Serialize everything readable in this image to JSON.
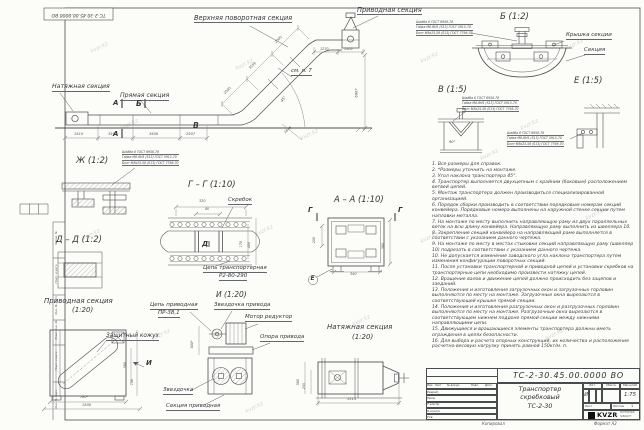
{
  "sheet": {
    "stamp": "ТС-2-30.45.00.0000 ВО",
    "watermark": "kvzr.kz",
    "copy_label": "Копировал",
    "format_label": "Формат А2",
    "frame_labels": [
      "Справ. №",
      "Подп. и дата",
      "Инв. № дубл.",
      "Взам. инв. №",
      "Подп. и дата",
      "Инв. № подл."
    ]
  },
  "main_view": {
    "labels": {
      "tension_section": "Натяжная секция",
      "straight_section": "Прямая секция",
      "upper_turn_section": "Верхняя поворотная секция",
      "drive_section": "Приводная секция",
      "see_note": "см. п. 7"
    },
    "markers": {
      "a": "А",
      "b": "Б",
      "v": "В"
    },
    "dims": {
      "d1": "1515",
      "d2": "3500",
      "d3": "3500",
      "d4": "2507",
      "d5": "1845",
      "d6": "2000",
      "d7": "3559",
      "d8": "2000",
      "d9": "1270",
      "d10": "1505",
      "height": "6907",
      "angle": "45°"
    }
  },
  "fastener_note": {
    "l1": "Шайба 8 ГОСТ 6958-78",
    "l2": "Гайка М8-6Н5 (S13) ГОСТ 5915-70",
    "l3": "Болт М8х25.58 (S13) ГОСТ 7798-70"
  },
  "details": {
    "zh": {
      "title": "Ж (1:2)"
    },
    "gg": {
      "title": "Г – Г (1:10)",
      "scraper": "Скребок",
      "chain1": "Цепь транспортерная",
      "chain2": "Р2-80-290",
      "marker_d": "Д",
      "dims": {
        "w": "320",
        "w2": "80",
        "h1": "170",
        "h2": "400"
      }
    },
    "aa": {
      "title": "А – А (1:10)",
      "marker_g": "Г",
      "marker_e": "Е",
      "dims": {
        "left": "200",
        "right": "380",
        "bottom": "340"
      }
    },
    "b": {
      "title": "Б (1:2)",
      "cover": "Крышка секции",
      "section": "Секция"
    },
    "v": {
      "title": "В (1:5)",
      "angle": "90°"
    },
    "e": {
      "title": "Е (1:5)"
    },
    "dd": {
      "title": "Д – Д (1:2)"
    },
    "drive": {
      "title": "Приводная секция",
      "scale": "(1:20)",
      "cover": "Защитный кожух",
      "marker_i": "И",
      "dims": {
        "d1": "780*",
        "d2": "1500",
        "d3": "560",
        "d4": "700"
      }
    },
    "i": {
      "title": "И (1:20)",
      "chain1": "Цепь приводная",
      "chain2": "ПР-38,1",
      "sprocket_drive": "Звездочка привода",
      "motor": "Мотор редуктор",
      "support": "Опора привода",
      "sprocket": "Звездочка",
      "section": "Секция приводная",
      "dim": "800*"
    },
    "tension": {
      "title": "Натяжная секция",
      "scale": "(1:20)",
      "dims": {
        "l": "1515",
        "h1": "560",
        "h2": "255"
      }
    }
  },
  "notes": [
    "1. Все размеры для справок.",
    "2. *Размеры уточнить на монтаже.",
    "3. Угол наклона транспортера 45°.",
    "4. Транспортер выполняется двухцепным с крайним (боковым) расположением ветвей цепей.",
    "5. Монтаж транспортера должен производиться специализированной организацией.",
    "6. Порядок сборки производить в соответствии порядковым номерам секций конвейера. Порядковые номера выполнены на наружной стенке секции путем наплавки металла.",
    "7. На монтаже по месту выполнить направляющую раму из двух параллельных веток на всю длину конвейера. Направляющую раму выполнить из швеллера 10.",
    "8. Закрепление секций конвейера на направляющей раме выполняется в соответствии с указанием данного чертежа.",
    "9. На монтаже по месту в местах стыковки секций направляющую раму (швеллер 10) подрезать в соответствии с указанием данного чертежа.",
    "10. Не допускается изменение заводского угла наклона транспортера путем изменения конфигурации поворотных секций.",
    "11. После установки транспортерной и приводной цепей и установки скребков на транспортерные цепи необходимо произвести натяжку цепей.",
    "12. Вращение валов и движение цепей должно происходить без зацепов и заеданий.",
    "13. Положения и изготовления загрузочных окон и загрузочных горловин выполняются по месту на монтаже. Загрузочные окна вырезаются в соответствующей крышке прямой секции.",
    "14. Положения и изготовления разгрузочных окон и разгрузочных горловин выполняются по месту на монтаже. Разгрузочные окна вырезаются в соответствующем нижнем поддоне прямой секции между нижними направляющими цепи.",
    "15. Движущиеся и вращающиеся элементы транспортера должны иметь ограждения в целях безопасности.",
    "16. Для выбора и расчета опорных конструкций, их количества и расположения расчетно-весовую нагрузку принять равной 150кг/м. п."
  ],
  "title_block": {
    "doc_number": "ТС-2-30.45.00.0000  ВО",
    "name1": "Транспортер",
    "name2": "скребковый",
    "name3": "ТС-2-30",
    "lit_header": "Лит.",
    "mass_header": "Масса",
    "scale_header": "Масштаб",
    "lit": "И",
    "scale": "1:75",
    "sheet_label": "Лист",
    "sheets_label": "Листов",
    "sheets_value": "1",
    "header": [
      "Изм.",
      "Лист",
      "№ докум.",
      "Подп.",
      "Дата"
    ],
    "r1": "Разраб.",
    "r2": "Пров.",
    "r3": "Т.контр.",
    "r4": "Н.контр.",
    "r5": "Утв.",
    "logo": "KVZR",
    "logo_sub1": "КОТЕЛЬНЫЙ",
    "logo_sub2": "ЗАВОД РТ"
  }
}
